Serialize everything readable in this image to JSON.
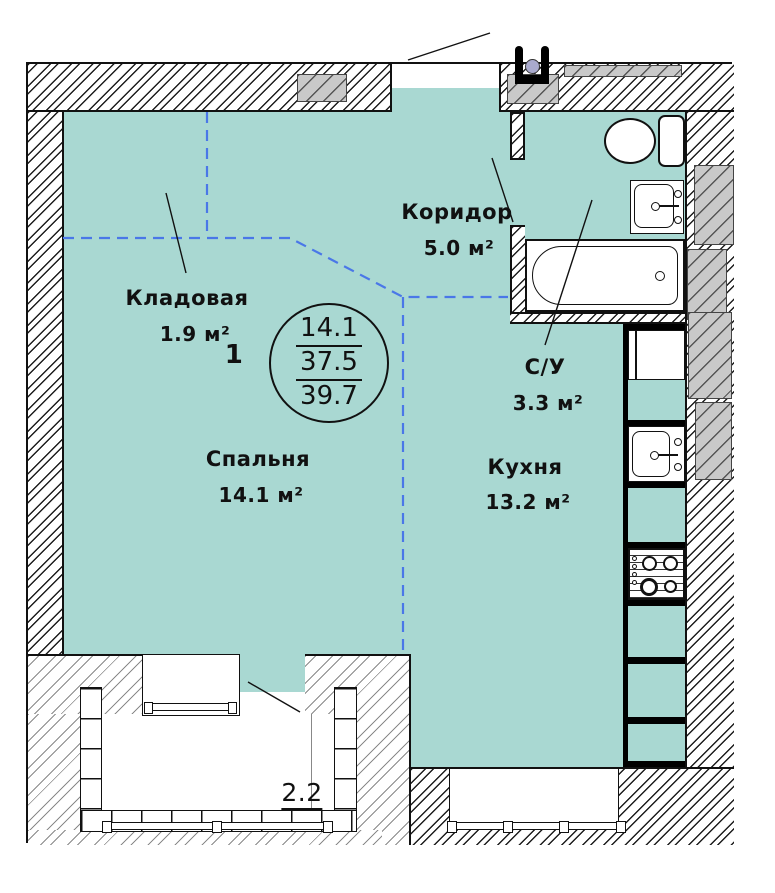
{
  "plan": {
    "unit_number": "1",
    "rooms": [
      {
        "name": "Кладовая",
        "area": "1.9 м²"
      },
      {
        "name": "Коридор",
        "area": "5.0 м²"
      },
      {
        "name": "С/У",
        "area": "3.3 м²"
      },
      {
        "name": "Кухня",
        "area": "13.2 м²"
      },
      {
        "name": "Спальня",
        "area": "14.1 м²"
      }
    ],
    "area_stamp": {
      "living": "14.1",
      "heated": "37.5",
      "total": "39.7"
    },
    "balcony_area": "2.2",
    "colors": {
      "floor": "#a9d8d2",
      "zoning_line": "#4a77e8",
      "wall_gray": "#c9c9c9"
    }
  }
}
